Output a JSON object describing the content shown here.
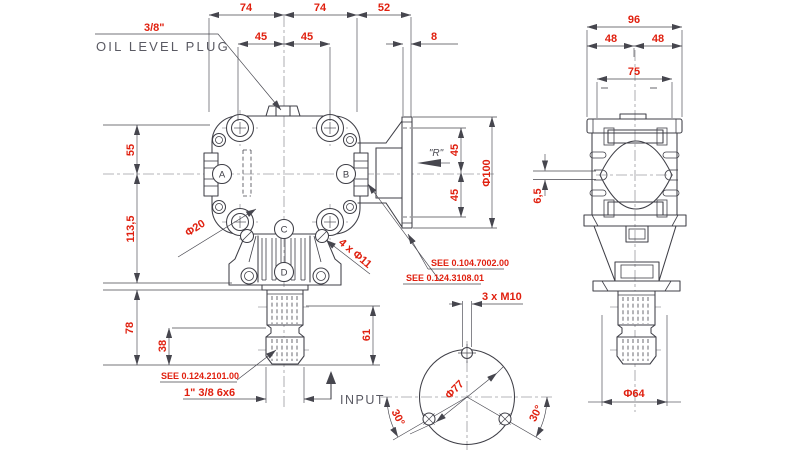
{
  "colors": {
    "dimension_red": "#e0200f",
    "drawing_line": "#3f3f47",
    "label_gray": "#5a5a63",
    "background": "#ffffff"
  },
  "front_view": {
    "oil_plug": {
      "size": "3/8\"",
      "label": "OIL LEVEL PLUG"
    },
    "top_dims": {
      "width_left": "74",
      "width_right": "74",
      "flange_offset": "52",
      "bolt_left": "45",
      "bolt_right": "45",
      "plate_thickness": "8"
    },
    "left_dims": {
      "upper": "55",
      "middle": "113,5",
      "lower": "78",
      "spline_length": "38"
    },
    "right_dims": {
      "flange_bolt_upper": "45",
      "flange_bolt_lower": "45",
      "flange_dia": "Φ100",
      "shaft_length": "61"
    },
    "labels": {
      "corner_hole": "Φ20",
      "mount_holes": "4 x Φ11",
      "rotation": "\"R\"",
      "spline_spec": "1\" 3/8 6x6",
      "input": "INPUT"
    },
    "notes": {
      "see_flange": "SEE 0.104.7002.00",
      "see_bearing": "SEE 0.124.3108.01",
      "see_shaft": "SEE 0.124.2101.00"
    },
    "ports": {
      "a": "A",
      "b": "B",
      "c": "C",
      "d": "D"
    }
  },
  "bottom_view": {
    "bolt_spec": "3 x M10",
    "bolt_circle_dia": "Φ77",
    "angle_left": "30°",
    "angle_right": "30°"
  },
  "side_view": {
    "overall_width": "96",
    "half_left": "48",
    "half_right": "48",
    "inner_width": "75",
    "slot_width": "6,5",
    "shaft_boss_dia": "Φ64"
  }
}
